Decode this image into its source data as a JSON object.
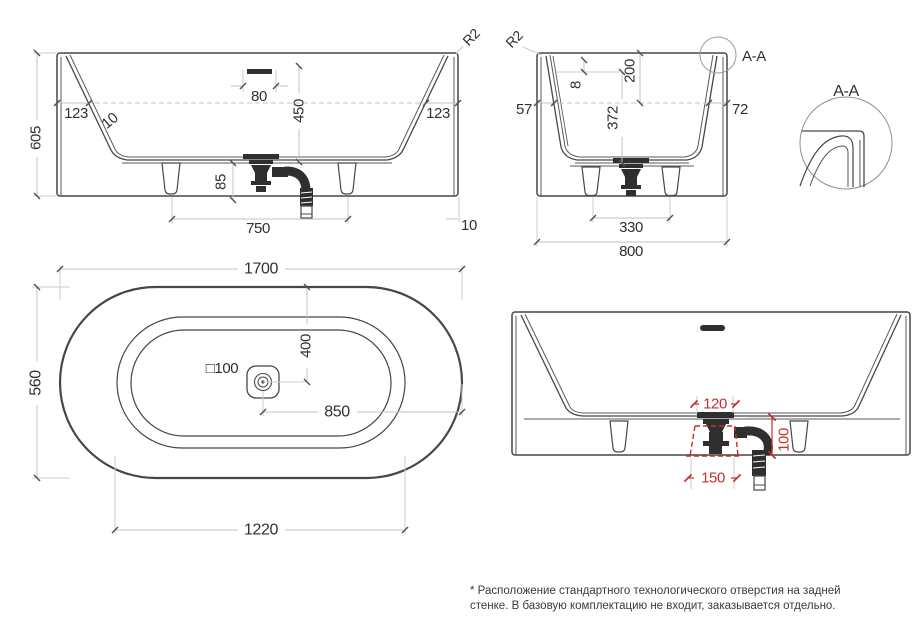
{
  "colors": {
    "object_line": "#474747",
    "dimension_line": "#c2c2c2",
    "text": "#303030",
    "accent_red": "#c62f2a"
  },
  "views": {
    "front": {
      "dims": {
        "height": "605",
        "rim_left": "123",
        "draft": "10",
        "overflow": "80",
        "depth": "450",
        "rim_right": "123",
        "radius": "R2",
        "drain_h": "85",
        "feet": "750",
        "wall": "10"
      }
    },
    "end": {
      "dims": {
        "radius": "R2",
        "rim_left": "57",
        "thickness": "8",
        "rim_h": "200",
        "depth": "372",
        "rim_right": "72",
        "feet": "330",
        "width": "800",
        "callout": "A-A"
      }
    },
    "detail": {
      "title": "A-A"
    },
    "plan": {
      "dims": {
        "length": "1700",
        "width": "560",
        "drain_y": "400",
        "drain_size": "□100",
        "drain_x": "850",
        "inner": "1220"
      }
    },
    "rear": {
      "dims": {
        "hole_w": "120",
        "hole_h": "100",
        "hole_base": "150"
      }
    }
  },
  "footnote": {
    "line1": "* Расположение стандартного технологического отверстия на задней",
    "line2": "стенке. В базовую комплектацию не входит, заказывается отдельно."
  }
}
